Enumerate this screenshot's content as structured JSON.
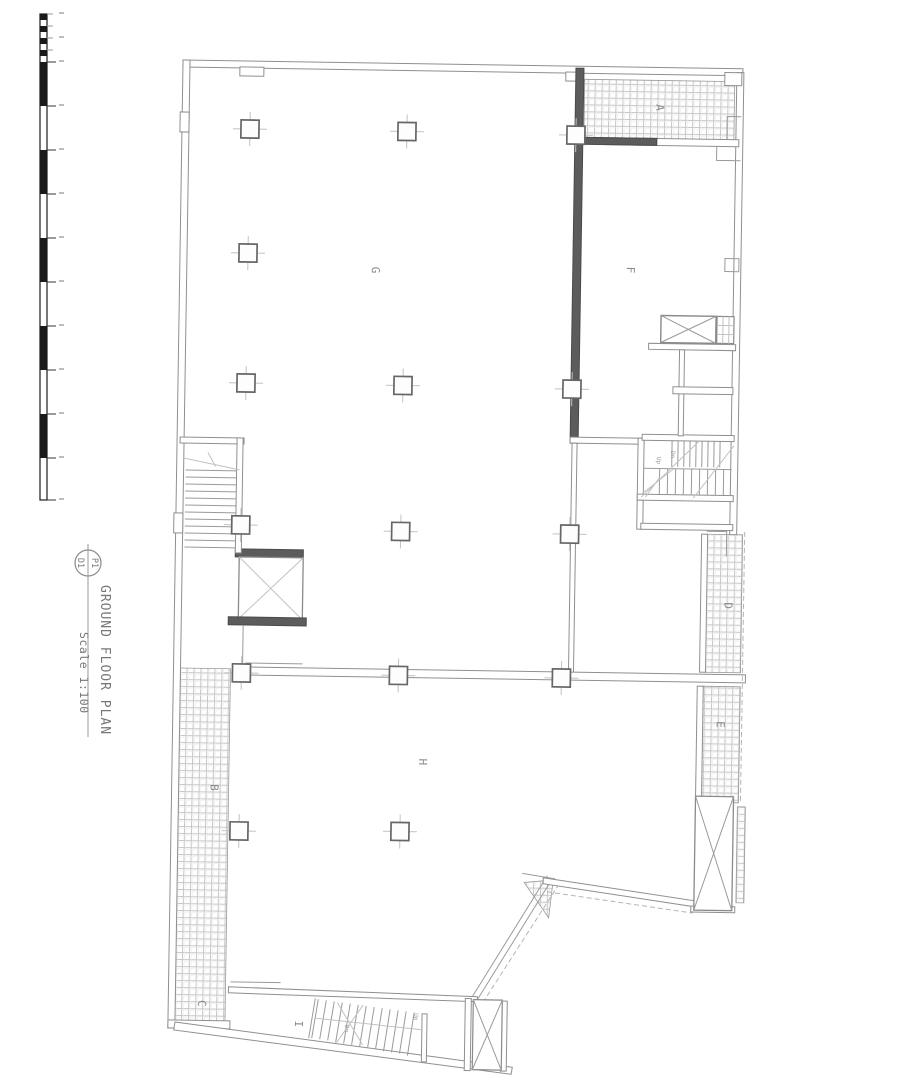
{
  "title_block": {
    "bubble_top": "P1",
    "bubble_bottom": "D1",
    "title": "GROUND FLOOR PLAN",
    "scale": "Scale 1:100"
  },
  "plan": {
    "rooms": [
      {
        "label": "A"
      },
      {
        "label": "B"
      },
      {
        "label": "C"
      },
      {
        "label": "D"
      },
      {
        "label": "E"
      },
      {
        "label": "F"
      },
      {
        "label": "G"
      },
      {
        "label": "H"
      },
      {
        "label": "I"
      }
    ],
    "stair_labels": [
      {
        "text": "Dn"
      },
      {
        "text": "Up"
      },
      {
        "text": "Dn"
      },
      {
        "text": "Up"
      }
    ]
  },
  "colors": {
    "background": "#ffffff",
    "wall": "#8f8f8f",
    "wall_dark": "#5c5c5c",
    "hatch_line": "#c6c6c6",
    "label_text": "#8a8a8a",
    "scale_bar": "#1a1a1a"
  }
}
